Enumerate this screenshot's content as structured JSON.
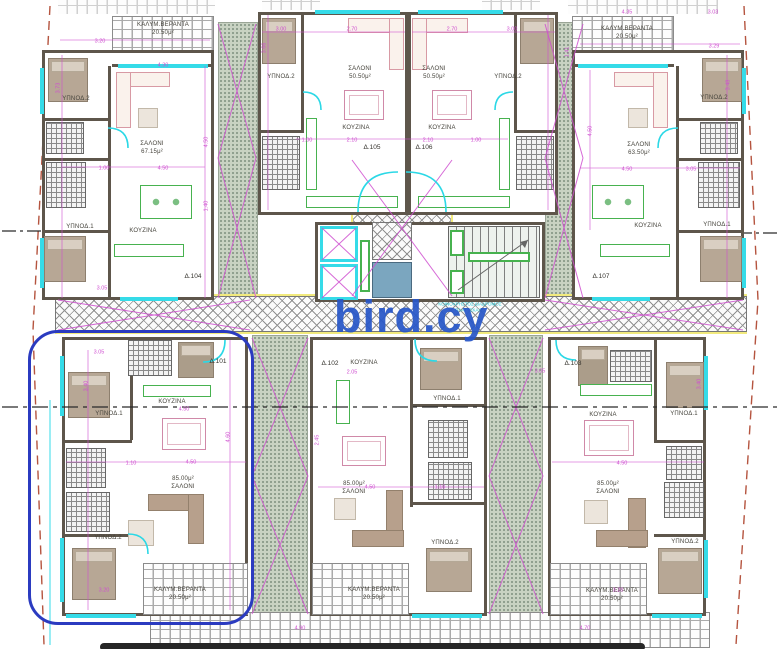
{
  "plan": {
    "watermark": "bird.cy",
    "corridor_note": "ΚΟΙΝΟΧΡΗΣΤΟΣ ΔΙΑΔΡΟΜΟΣ\nΠΛΑΤΥΣΚΑΛΟ",
    "units": [
      "Δ.101",
      "Δ.102",
      "Δ.103",
      "Δ.104",
      "Δ.105",
      "Δ.106",
      "Δ.107"
    ],
    "colors": {
      "wall": "#5e564b",
      "glass": "#35dbe8",
      "dim": "#cf4fd0",
      "green": "#47b24f",
      "yellow": "#f2ea7d",
      "highlight": "#2b3bc0",
      "watermark": "#2857c8",
      "boundary": "#b5543f"
    },
    "labels": [
      {
        "t": "ΚΑΛΥΜ.ΒΕΡΑΝΤΑ\n20.50μ²",
        "x": 163,
        "y": 30,
        "cls": "area"
      },
      {
        "t": "ΥΠΝΟΔ.2",
        "x": 76,
        "y": 100,
        "cls": "room"
      },
      {
        "t": "ΣΑΛΟΝΙ\n67.15μ²",
        "x": 152,
        "y": 149,
        "cls": "area"
      },
      {
        "t": "ΥΠΝΟΔ.1",
        "x": 80,
        "y": 228,
        "cls": "room"
      },
      {
        "t": "ΚΟΥΖΙΝΑ",
        "x": 143,
        "y": 232,
        "cls": "room"
      },
      {
        "t": "Δ.104",
        "x": 193,
        "y": 277,
        "cls": "unit"
      },
      {
        "t": "ΥΠΝΟΔ.2",
        "x": 281,
        "y": 78,
        "cls": "room"
      },
      {
        "t": "ΣΑΛΟΝΙ\n50.50μ²",
        "x": 360,
        "y": 74,
        "cls": "area"
      },
      {
        "t": "ΚΟΥΖΙΝΑ",
        "x": 356,
        "y": 129,
        "cls": "room"
      },
      {
        "t": "Δ.105",
        "x": 372,
        "y": 148,
        "cls": "unit"
      },
      {
        "t": "ΣΑΛΟΝΙ\n50.50μ²",
        "x": 434,
        "y": 74,
        "cls": "area"
      },
      {
        "t": "ΚΟΥΖΙΝΑ",
        "x": 442,
        "y": 129,
        "cls": "room"
      },
      {
        "t": "Δ.106",
        "x": 424,
        "y": 148,
        "cls": "unit"
      },
      {
        "t": "ΥΠΝΟΔ.2",
        "x": 508,
        "y": 78,
        "cls": "room"
      },
      {
        "t": "ΚΑΛΥΜ.ΒΕΡΑΝΤΑ\n20.50μ²",
        "x": 627,
        "y": 34,
        "cls": "area"
      },
      {
        "t": "ΥΠΝΟΔ.2",
        "x": 714,
        "y": 99,
        "cls": "room"
      },
      {
        "t": "ΣΑΛΟΝΙ\n63.50μ²",
        "x": 639,
        "y": 150,
        "cls": "area"
      },
      {
        "t": "ΚΟΥΖΙΝΑ",
        "x": 648,
        "y": 227,
        "cls": "room"
      },
      {
        "t": "ΥΠΝΟΔ.1",
        "x": 717,
        "y": 226,
        "cls": "room"
      },
      {
        "t": "Δ.107",
        "x": 601,
        "y": 277,
        "cls": "unit"
      },
      {
        "t": "Δ.101",
        "x": 218,
        "y": 362,
        "cls": "unit"
      },
      {
        "t": "ΚΟΥΖΙΝΑ",
        "x": 172,
        "y": 403,
        "cls": "room"
      },
      {
        "t": "ΥΠΝΟΔ.1",
        "x": 109,
        "y": 415,
        "cls": "room"
      },
      {
        "t": "85.00μ²\nΣΑΛΟΝΙ",
        "x": 183,
        "y": 484,
        "cls": "area"
      },
      {
        "t": "ΥΠΝΟΔ.2",
        "x": 108,
        "y": 539,
        "cls": "room"
      },
      {
        "t": "ΚΑΛΥΜ.ΒΕΡΑΝΤΑ\n20.50μ²",
        "x": 180,
        "y": 595,
        "cls": "area"
      },
      {
        "t": "Δ.102",
        "x": 330,
        "y": 364,
        "cls": "unit"
      },
      {
        "t": "ΚΟΥΖΙΝΑ",
        "x": 364,
        "y": 364,
        "cls": "room"
      },
      {
        "t": "ΥΠΝΟΔ.1",
        "x": 447,
        "y": 400,
        "cls": "room"
      },
      {
        "t": "85.00μ²\nΣΑΛΟΝΙ",
        "x": 354,
        "y": 489,
        "cls": "area"
      },
      {
        "t": "ΥΠΝΟΔ.2",
        "x": 445,
        "y": 544,
        "cls": "room"
      },
      {
        "t": "ΚΑΛΥΜ.ΒΕΡΑΝΤΑ\n20.50μ²",
        "x": 374,
        "y": 595,
        "cls": "area"
      },
      {
        "t": "Δ.103",
        "x": 573,
        "y": 364,
        "cls": "unit"
      },
      {
        "t": "ΚΟΥΖΙΝΑ",
        "x": 603,
        "y": 416,
        "cls": "room"
      },
      {
        "t": "ΥΠΝΟΔ.1",
        "x": 684,
        "y": 415,
        "cls": "room"
      },
      {
        "t": "85.00μ²\nΣΑΛΟΝΙ",
        "x": 608,
        "y": 489,
        "cls": "area"
      },
      {
        "t": "ΥΠΝΟΔ.2",
        "x": 685,
        "y": 543,
        "cls": "room"
      },
      {
        "t": "ΚΑΛΥΜ.ΒΕΡΑΝΤΑ\n20.50μ²",
        "x": 612,
        "y": 596,
        "cls": "area"
      },
      {
        "t": "3.20",
        "x": 100,
        "y": 42,
        "cls": "dim"
      },
      {
        "t": "3.73",
        "x": 59,
        "y": 88,
        "cls": "dim",
        "r": 90
      },
      {
        "t": "4.30",
        "x": 163,
        "y": 66,
        "cls": "dim"
      },
      {
        "t": "4.50",
        "x": 207,
        "y": 142,
        "cls": "dim",
        "r": 90
      },
      {
        "t": "1.00",
        "x": 104,
        "y": 169,
        "cls": "dim"
      },
      {
        "t": "4.50",
        "x": 163,
        "y": 169,
        "cls": "dim"
      },
      {
        "t": "1.40",
        "x": 207,
        "y": 206,
        "cls": "dim",
        "r": 90
      },
      {
        "t": "3.05",
        "x": 102,
        "y": 289,
        "cls": "dim"
      },
      {
        "t": "3.00",
        "x": 281,
        "y": 30,
        "cls": "dim"
      },
      {
        "t": "2.70",
        "x": 352,
        "y": 30,
        "cls": "dim"
      },
      {
        "t": "2.70",
        "x": 452,
        "y": 30,
        "cls": "dim"
      },
      {
        "t": "3.00",
        "x": 512,
        "y": 30,
        "cls": "dim"
      },
      {
        "t": "3.66",
        "x": 265,
        "y": 48,
        "cls": "dim",
        "r": 90
      },
      {
        "t": "1.00",
        "x": 307,
        "y": 141,
        "cls": "dim"
      },
      {
        "t": "2.10",
        "x": 352,
        "y": 141,
        "cls": "dim"
      },
      {
        "t": "2.10",
        "x": 428,
        "y": 141,
        "cls": "dim"
      },
      {
        "t": "1.00",
        "x": 476,
        "y": 141,
        "cls": "dim"
      },
      {
        "t": "4.35",
        "x": 627,
        "y": 13,
        "cls": "dim"
      },
      {
        "t": "3.03",
        "x": 713,
        "y": 13,
        "cls": "dim"
      },
      {
        "t": "3.29",
        "x": 714,
        "y": 47,
        "cls": "dim"
      },
      {
        "t": "1.41",
        "x": 568,
        "y": 52,
        "cls": "dim",
        "r": 90
      },
      {
        "t": "4.50",
        "x": 591,
        "y": 131,
        "cls": "dim",
        "r": 90
      },
      {
        "t": "3.48",
        "x": 729,
        "y": 85,
        "cls": "dim",
        "r": 90
      },
      {
        "t": "4.50",
        "x": 627,
        "y": 170,
        "cls": "dim"
      },
      {
        "t": "3.05",
        "x": 691,
        "y": 170,
        "cls": "dim"
      },
      {
        "t": "3.05",
        "x": 99,
        "y": 353,
        "cls": "dim"
      },
      {
        "t": "3.40",
        "x": 87,
        "y": 386,
        "cls": "dim",
        "r": 90
      },
      {
        "t": "4.50",
        "x": 184,
        "y": 410,
        "cls": "dim"
      },
      {
        "t": "4.50",
        "x": 191,
        "y": 463,
        "cls": "dim"
      },
      {
        "t": "1.10",
        "x": 131,
        "y": 464,
        "cls": "dim"
      },
      {
        "t": "4.60",
        "x": 229,
        "y": 437,
        "cls": "dim",
        "r": 90
      },
      {
        "t": "3.20",
        "x": 104,
        "y": 591,
        "cls": "dim"
      },
      {
        "t": "3.05",
        "x": 540,
        "y": 372,
        "cls": "dim"
      },
      {
        "t": "2.05",
        "x": 352,
        "y": 373,
        "cls": "dim"
      },
      {
        "t": "4.50",
        "x": 370,
        "y": 488,
        "cls": "dim"
      },
      {
        "t": "1.10",
        "x": 440,
        "y": 488,
        "cls": "dim"
      },
      {
        "t": "2.45",
        "x": 318,
        "y": 440,
        "cls": "dim",
        "r": 90
      },
      {
        "t": "3.40",
        "x": 700,
        "y": 384,
        "cls": "dim",
        "r": 90
      },
      {
        "t": "4.50",
        "x": 622,
        "y": 464,
        "cls": "dim"
      },
      {
        "t": "3.20",
        "x": 618,
        "y": 591,
        "cls": "dim"
      },
      {
        "t": "4.90",
        "x": 300,
        "y": 629,
        "cls": "dim"
      },
      {
        "t": "4.70",
        "x": 585,
        "y": 629,
        "cls": "dim"
      }
    ]
  }
}
